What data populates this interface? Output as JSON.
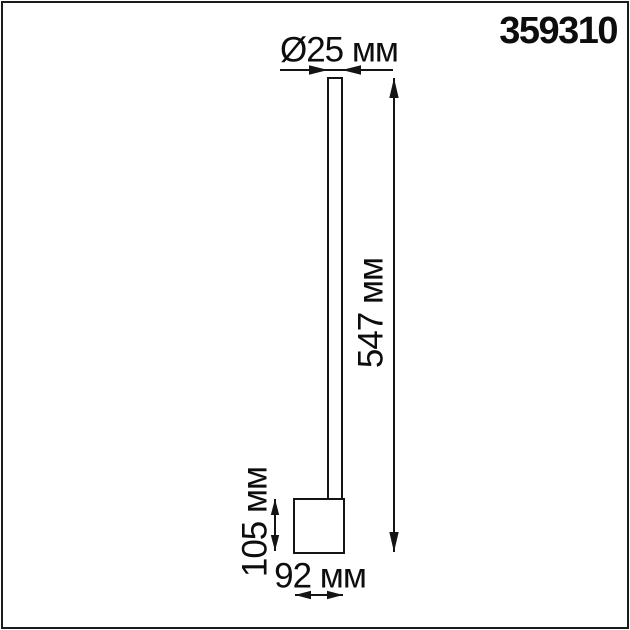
{
  "product_code": "359310",
  "colors": {
    "ink": "#141414",
    "background": "#ffffff"
  },
  "dimensions": {
    "diameter": {
      "label": "Ø25 мм",
      "value": 25,
      "unit": "мм"
    },
    "total_height": {
      "label": "547 мм",
      "value": 547,
      "unit": "мм"
    },
    "base_height": {
      "label": "105 мм",
      "value": 105,
      "unit": "мм"
    },
    "base_width": {
      "label": "92 мм",
      "value": 92,
      "unit": "мм"
    }
  }
}
